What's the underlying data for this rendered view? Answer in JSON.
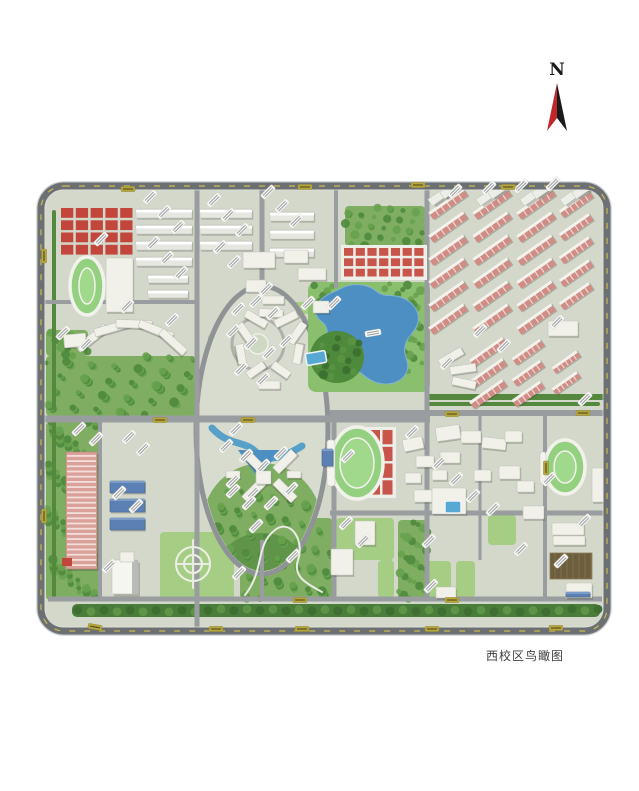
{
  "caption": {
    "text": "西校区鸟瞰图"
  },
  "compass": {
    "letter": "N",
    "red": "#c0272b",
    "black": "#1a1a1a"
  },
  "palette": {
    "base": "#d3d8ca",
    "perimeter_road": "#6c7073",
    "road": "#9a9da0",
    "woods_dark": "#4f8a3e",
    "woods_mid": "#67a24e",
    "lawn": "#a6cd84",
    "track_green": "#93d07f",
    "track_inner": "#a0d88c",
    "track_line": "#f2f2ec",
    "red_roof": "#c2463c",
    "court_red": "#c8554a",
    "dorm_pink": "#d08d86",
    "building_white": "#f1f1ea",
    "building_shadow": "rgba(60,65,55,0.28)",
    "lake_blue": "#4d8fc2",
    "canal_blue": "#57a0c8",
    "pool_blue": "#58a8d4",
    "roof_blue": "#5b80b4",
    "label_white": "#f8f8f5",
    "label_olive": "#b5a640",
    "dash_yellow": "#d4c44e",
    "boulevard": "#4a7c3a",
    "parking_brown": "#6d5f3d"
  },
  "map": {
    "frame": {
      "x": 41,
      "y": 186,
      "w": 566,
      "h": 445,
      "r": 23
    },
    "roads": {
      "horizontal": [
        [
          44,
          197,
          302,
          4
        ],
        [
          44,
          430,
          419,
          7
        ],
        [
          330,
          604,
          413,
          6
        ],
        [
          330,
          604,
          513,
          5
        ],
        [
          48,
          602,
          599,
          5
        ]
      ],
      "vertical": [
        [
          197,
          188,
          630,
          5
        ],
        [
          262,
          188,
          292,
          5
        ],
        [
          336,
          188,
          288,
          4
        ],
        [
          427,
          188,
          600,
          5
        ],
        [
          100,
          419,
          598,
          4
        ],
        [
          334,
          419,
          600,
          5
        ],
        [
          480,
          413,
          560,
          3
        ],
        [
          545,
          413,
          600,
          4
        ],
        [
          262,
          540,
          598,
          4
        ]
      ]
    },
    "lawns": [
      [
        232,
        296,
        30,
        14
      ],
      [
        288,
        302,
        26,
        12
      ],
      [
        208,
        334,
        13,
        34
      ],
      [
        314,
        334,
        13,
        34
      ],
      [
        336,
        518,
        58,
        42
      ],
      [
        422,
        561,
        29,
        37
      ],
      [
        456,
        561,
        19,
        37
      ],
      [
        378,
        560,
        16,
        38
      ],
      [
        160,
        532,
        74,
        68
      ],
      [
        488,
        515,
        28,
        30
      ]
    ],
    "woods": [
      [
        345,
        206,
        80,
        40
      ],
      [
        46,
        356,
        150,
        60
      ],
      [
        46,
        422,
        52,
        178
      ],
      [
        240,
        518,
        92,
        82
      ],
      [
        398,
        520,
        30,
        80
      ],
      [
        46,
        330,
        42,
        26
      ]
    ],
    "hedges": [
      [
        428,
        394,
        176,
        6
      ],
      [
        428,
        402,
        172,
        4
      ],
      [
        52,
        210,
        4,
        200
      ],
      [
        52,
        420,
        4,
        180
      ]
    ],
    "boulevard": {
      "x1": 72,
      "x2": 600,
      "y": 604,
      "h": 13
    },
    "ellipse": {
      "cx": 262,
      "cy": 430,
      "rx": 66,
      "ry": 144
    },
    "plaza": {
      "cx": 258,
      "cy": 344,
      "r": 26
    },
    "lake": {
      "bank": [
        308,
        282,
        122,
        110
      ],
      "path": "M 340,289 C 352,282 368,284 376,291 C 384,298 392,294 400,297 C 412,301 420,310 418,322 C 416,332 407,336 405,346 C 403,356 410,362 407,371 C 403,382 390,386 378,383 C 366,380 362,371 352,369 C 340,367 330,373 321,366 C 312,359 315,348 322,342 C 330,335 328,326 321,321 C 313,315 315,303 324,297 C 330,293 334,292 340,289 Z"
    },
    "hill": {
      "cx": 337,
      "cy": 357,
      "rx": 27,
      "ry": 26
    },
    "canal": {
      "d": "M 212,428 C 228,446 244,440 256,452 C 268,464 286,456 302,446",
      "pond": "238,450 280,450 259,479"
    },
    "tracks": [
      [
        87,
        286,
        17,
        29
      ],
      [
        357,
        463,
        26,
        36
      ],
      [
        565,
        467,
        20,
        27
      ]
    ],
    "stands": [
      [
        327,
        440,
        8,
        46
      ],
      [
        540,
        452,
        6,
        32
      ]
    ],
    "red_squares": {
      "x": 60,
      "y": 207,
      "w": 74,
      "h": 49,
      "cols": 5,
      "rows": 4
    },
    "red_grids": [
      [
        343,
        247,
        82,
        31,
        7,
        3
      ],
      [
        369,
        429,
        25,
        67,
        2,
        4
      ]
    ],
    "bar_rows": [
      {
        "x": 136,
        "y0": 209,
        "rows": 4,
        "gap": 16,
        "len": 56,
        "h": 9
      },
      {
        "x": 200,
        "y0": 209,
        "rows": 3,
        "gap": 16,
        "len": 52,
        "h": 9
      },
      {
        "x": 270,
        "y0": 212,
        "rows": 3,
        "gap": 18,
        "len": 44,
        "h": 9
      },
      {
        "x": 148,
        "y0": 275,
        "rows": 2,
        "gap": 15,
        "len": 40,
        "h": 8
      }
    ],
    "dorm_clusters": [
      {
        "cx": 448,
        "y0": 204,
        "rows": 6,
        "gap": 23,
        "len": 42,
        "h": 9
      },
      {
        "cx": 492,
        "y0": 204,
        "rows": 6,
        "gap": 23,
        "len": 42,
        "h": 9
      },
      {
        "cx": 536,
        "y0": 204,
        "rows": 6,
        "gap": 23,
        "len": 42,
        "h": 9
      },
      {
        "cx": 576,
        "y0": 204,
        "rows": 5,
        "gap": 23,
        "len": 36,
        "h": 9
      },
      {
        "cx": 488,
        "y0": 352,
        "rows": 3,
        "gap": 21,
        "len": 40,
        "h": 9
      },
      {
        "cx": 528,
        "y0": 352,
        "rows": 3,
        "gap": 21,
        "len": 34,
        "h": 9
      },
      {
        "cx": 566,
        "y0": 362,
        "rows": 2,
        "gap": 21,
        "len": 30,
        "h": 8
      }
    ],
    "towers": [
      [
        444,
        193
      ],
      [
        456,
        186
      ],
      [
        492,
        193
      ],
      [
        504,
        186
      ],
      [
        536,
        193
      ],
      [
        548,
        186
      ],
      [
        576,
        193
      ],
      [
        588,
        186
      ]
    ],
    "buildings": [
      [
        106,
        258,
        27,
        54,
        0
      ],
      [
        243,
        252,
        32,
        16,
        0
      ],
      [
        284,
        250,
        24,
        13,
        0
      ],
      [
        298,
        268,
        28,
        12,
        0
      ],
      [
        246,
        280,
        20,
        12,
        0
      ],
      [
        262,
        296,
        22,
        8,
        0
      ],
      [
        74,
        334,
        36,
        8,
        -38
      ],
      [
        94,
        324,
        36,
        8,
        -16
      ],
      [
        116,
        320,
        36,
        8,
        2
      ],
      [
        138,
        326,
        36,
        8,
        22
      ],
      [
        157,
        338,
        32,
        8,
        42
      ],
      [
        64,
        334,
        22,
        13,
        -5
      ],
      [
        234,
        330,
        24,
        8,
        55
      ],
      [
        244,
        315,
        24,
        8,
        30
      ],
      [
        259,
        309,
        24,
        8,
        3
      ],
      [
        274,
        315,
        24,
        8,
        -26
      ],
      [
        285,
        329,
        24,
        8,
        -55
      ],
      [
        231,
        350,
        20,
        8,
        80
      ],
      [
        288,
        350,
        20,
        8,
        -80
      ],
      [
        246,
        366,
        20,
        8,
        -35
      ],
      [
        271,
        366,
        20,
        8,
        35
      ],
      [
        258,
        381,
        22,
        8,
        0
      ],
      [
        241,
        457,
        26,
        9,
        45
      ],
      [
        272,
        457,
        26,
        9,
        -45
      ],
      [
        241,
        486,
        26,
        9,
        -45
      ],
      [
        272,
        486,
        26,
        9,
        45
      ],
      [
        256,
        471,
        15,
        13,
        0
      ],
      [
        226,
        471,
        14,
        7,
        0
      ],
      [
        287,
        471,
        14,
        7,
        0
      ],
      [
        313,
        301,
        16,
        12,
        0
      ],
      [
        548,
        321,
        30,
        15,
        0
      ],
      [
        438,
        353,
        26,
        8,
        -30
      ],
      [
        450,
        365,
        26,
        8,
        -8
      ],
      [
        452,
        379,
        24,
        8,
        12
      ],
      [
        403,
        438,
        20,
        12,
        -12
      ],
      [
        416,
        456,
        18,
        11,
        0
      ],
      [
        405,
        473,
        16,
        10,
        0
      ],
      [
        414,
        490,
        18,
        12,
        0
      ],
      [
        436,
        426,
        24,
        14,
        -8
      ],
      [
        461,
        431,
        20,
        12,
        0
      ],
      [
        482,
        438,
        24,
        11,
        6
      ],
      [
        505,
        431,
        17,
        11,
        0
      ],
      [
        440,
        452,
        20,
        11,
        0
      ],
      [
        432,
        470,
        15,
        10,
        0
      ],
      [
        474,
        470,
        17,
        11,
        0
      ],
      [
        499,
        466,
        21,
        13,
        0
      ],
      [
        517,
        481,
        17,
        11,
        0
      ],
      [
        523,
        506,
        21,
        13,
        0
      ],
      [
        552,
        523,
        32,
        12,
        0
      ],
      [
        553,
        536,
        32,
        9,
        0
      ],
      [
        566,
        583,
        26,
        15,
        0
      ],
      [
        592,
        468,
        12,
        34,
        0
      ],
      [
        355,
        521,
        20,
        24,
        0
      ],
      [
        331,
        549,
        22,
        26,
        0
      ],
      [
        436,
        587,
        20,
        11,
        0
      ],
      [
        432,
        488,
        34,
        26,
        0
      ]
    ],
    "blue_buildings": [
      [
        110,
        481,
        35,
        12
      ],
      [
        110,
        499,
        35,
        13
      ],
      [
        110,
        518,
        35,
        12
      ],
      [
        322,
        449,
        11,
        17
      ],
      [
        566,
        592,
        24,
        5
      ]
    ],
    "striped_building": {
      "x": 66,
      "y": 452,
      "w": 31,
      "h": 117
    },
    "tower": {
      "x": 112,
      "y": 560,
      "w": 26,
      "h": 34
    },
    "red_hut": [
      62,
      558,
      10,
      8
    ],
    "pools": [
      [
        306,
        352,
        20,
        12,
        -10
      ],
      [
        445,
        501,
        16,
        12,
        0
      ]
    ],
    "parking": {
      "x": 550,
      "y": 553,
      "w": 42,
      "h": 26
    },
    "garden": {
      "cx": 193,
      "cy": 564,
      "radii": [
        17,
        9
      ]
    },
    "paths": [
      {
        "d": "M 245,595 C 265,570 255,545 275,530 C 290,518 305,540 298,560 C 292,578 310,585 322,592",
        "w": 2
      },
      {
        "d": "M 176,564 L 210,564 M 193,540 L 193,588",
        "w": 2
      }
    ],
    "building_labels": [
      [
        150,
        197
      ],
      [
        164,
        212
      ],
      [
        178,
        227
      ],
      [
        153,
        243
      ],
      [
        167,
        258
      ],
      [
        181,
        273
      ],
      [
        214,
        200
      ],
      [
        228,
        215
      ],
      [
        242,
        230
      ],
      [
        220,
        247
      ],
      [
        234,
        262
      ],
      [
        101,
        239
      ],
      [
        127,
        306
      ],
      [
        268,
        192
      ],
      [
        282,
        206
      ],
      [
        296,
        221
      ],
      [
        266,
        289
      ],
      [
        308,
        303
      ],
      [
        455,
        191
      ],
      [
        489,
        188
      ],
      [
        521,
        186
      ],
      [
        553,
        184
      ],
      [
        480,
        331
      ],
      [
        504,
        346
      ],
      [
        447,
        363
      ],
      [
        557,
        322
      ],
      [
        585,
        399
      ],
      [
        373,
        333,
        -10
      ],
      [
        334,
        303
      ],
      [
        63,
        333
      ],
      [
        86,
        344
      ],
      [
        172,
        320
      ],
      [
        238,
        309
      ],
      [
        256,
        301
      ],
      [
        273,
        313
      ],
      [
        233,
        331
      ],
      [
        251,
        343
      ],
      [
        269,
        353
      ],
      [
        286,
        341
      ],
      [
        241,
        369
      ],
      [
        263,
        379
      ],
      [
        226,
        446
      ],
      [
        246,
        456
      ],
      [
        263,
        466
      ],
      [
        281,
        453
      ],
      [
        233,
        481
      ],
      [
        253,
        493
      ],
      [
        271,
        503
      ],
      [
        291,
        489
      ],
      [
        256,
        526
      ],
      [
        79,
        429
      ],
      [
        96,
        439
      ],
      [
        129,
        437
      ],
      [
        143,
        449
      ],
      [
        236,
        429
      ],
      [
        119,
        493
      ],
      [
        136,
        506
      ],
      [
        233,
        491
      ],
      [
        249,
        503
      ],
      [
        109,
        566
      ],
      [
        239,
        573
      ],
      [
        293,
        556
      ],
      [
        346,
        523
      ],
      [
        363,
        541
      ],
      [
        348,
        456
      ],
      [
        439,
        463
      ],
      [
        456,
        479
      ],
      [
        473,
        496
      ],
      [
        493,
        509
      ],
      [
        429,
        541
      ],
      [
        549,
        479
      ],
      [
        521,
        549
      ],
      [
        561,
        561
      ],
      [
        431,
        586
      ],
      [
        584,
        521
      ],
      [
        412,
        432
      ]
    ],
    "road_labels": [
      [
        128,
        189,
        0
      ],
      [
        305,
        187,
        0
      ],
      [
        418,
        185,
        0
      ],
      [
        508,
        187,
        0
      ],
      [
        44,
        256,
        90
      ],
      [
        44,
        516,
        90
      ],
      [
        95,
        627,
        10
      ],
      [
        216,
        629,
        0
      ],
      [
        302,
        629,
        0
      ],
      [
        432,
        629,
        0
      ],
      [
        556,
        628,
        0
      ],
      [
        160,
        420,
        0
      ],
      [
        248,
        420,
        0
      ],
      [
        452,
        414,
        0
      ],
      [
        583,
        413,
        0
      ],
      [
        300,
        600,
        0
      ],
      [
        452,
        600,
        0
      ],
      [
        546,
        468,
        90
      ]
    ]
  }
}
